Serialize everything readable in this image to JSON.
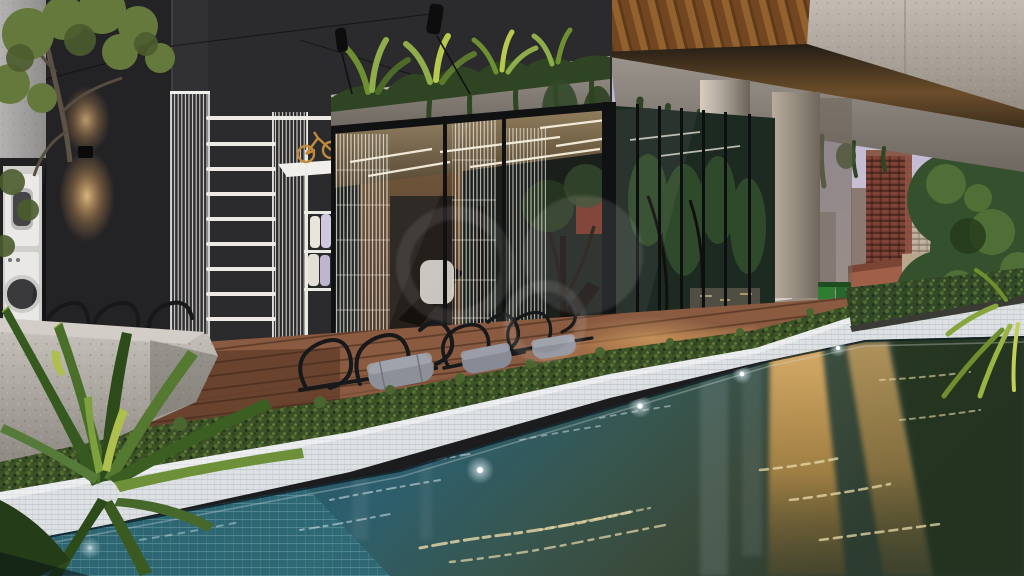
{
  "scene": {
    "type": "architectural-render",
    "title": "rooftop-leisure-area-dusk-render",
    "elements": [
      "dark-charcoal-tower-wall",
      "wall-sconce-uplight-downlight",
      "laundry-room-with-washer-dryer",
      "white-wire-trellis-ladders",
      "white-shelf-with-rolled-towels",
      "gold-bike-figurine",
      "glass-gym-pavilion",
      "concrete-roof-planter-with-bromeliads",
      "hanging-vines",
      "black-track-spotlights",
      "timber-deck",
      "wireframe-loungers-with-grey-bolsters",
      "groundcover-hedge",
      "white-tiled-pool-coping",
      "lap-pool-with-underwater-lights",
      "golden-city-reflections",
      "concrete-cantilever-with-timber-soffit",
      "twin-concrete-columns",
      "green-bins",
      "city-skyline-red-brick-tower",
      "street-trees",
      "lavender-dusk-sky",
      "translucent-circle-watermark"
    ]
  },
  "colors": {
    "sky_top": "#b6b3d6",
    "sky_bottom": "#ddcfc8",
    "dark_wall": "#2b2a2c",
    "dark_wall_left": "#232225",
    "grey_wall": "#a8a5a4",
    "concrete": "#b3aaa2",
    "wood_soffit": "#b5793a",
    "trellis_white": "#eceae4",
    "foliage_dark": "#2e4422",
    "foliage_mid": "#4a6a2e",
    "foliage_light": "#8fae4b",
    "deck_wood": "#8a5b41",
    "hedge_green": "#3c5128",
    "coping_white": "#dde1e3",
    "water_deep": "#1c333d",
    "water_teal": "#2d5f6e",
    "reflection_gold": "#c9984e",
    "interior_warm": "#7a5838",
    "pillow_grey": "#8c9099",
    "wire_black": "#17181a",
    "brick_tower": "#7f4437",
    "cream_tower": "#c2b2a0",
    "bin_green": "#2e7d32",
    "led_white": "#fff8e8"
  }
}
